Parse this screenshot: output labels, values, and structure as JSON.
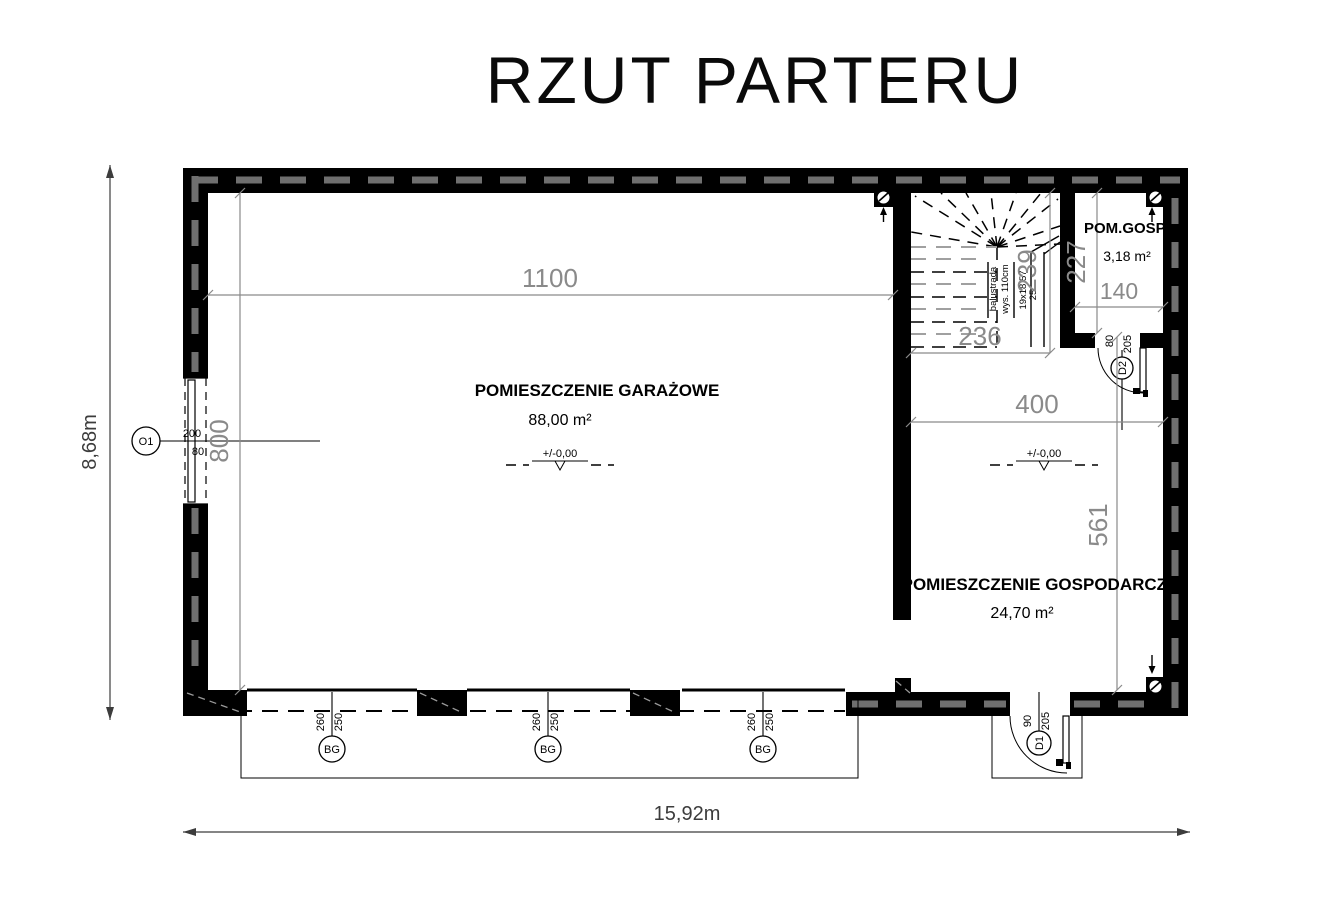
{
  "title": "RZUT PARTERU",
  "rooms": {
    "garage": {
      "name": "POMIESZCZENIE GARAŻOWE",
      "area": "88,00 m²"
    },
    "utility": {
      "name": "POMIESZCZENIE GOSPODARCZE",
      "area": "24,70 m²"
    },
    "storage": {
      "name": "POM.GOSP",
      "area": "3,18 m²"
    }
  },
  "level_mark": "+/-0,00",
  "stairs": {
    "balustrade_label": "balustrada",
    "balustrade_height": "wys. 110cm",
    "steps": "19x18,57",
    "tread_depth": "25"
  },
  "dimensions": {
    "overall_width": "15,92m",
    "overall_depth": "8,68m",
    "garage_width": "1100",
    "garage_depth": "800",
    "stair_width": "236",
    "stair_depth": "239",
    "storage_depth": "227",
    "storage_width": "140",
    "utility_width": "400",
    "utility_depth": "561"
  },
  "openings": {
    "window_o1": {
      "label": "O1",
      "size_top": "200",
      "size_bottom": "80"
    },
    "garage_door": {
      "label": "BG",
      "size_top": "260",
      "size_bottom": "250"
    },
    "door_d1": {
      "label": "D1",
      "size_top": "90",
      "size_bottom": "205"
    },
    "door_d2": {
      "label": "D2",
      "size_top": "80",
      "size_bottom": "205"
    }
  }
}
